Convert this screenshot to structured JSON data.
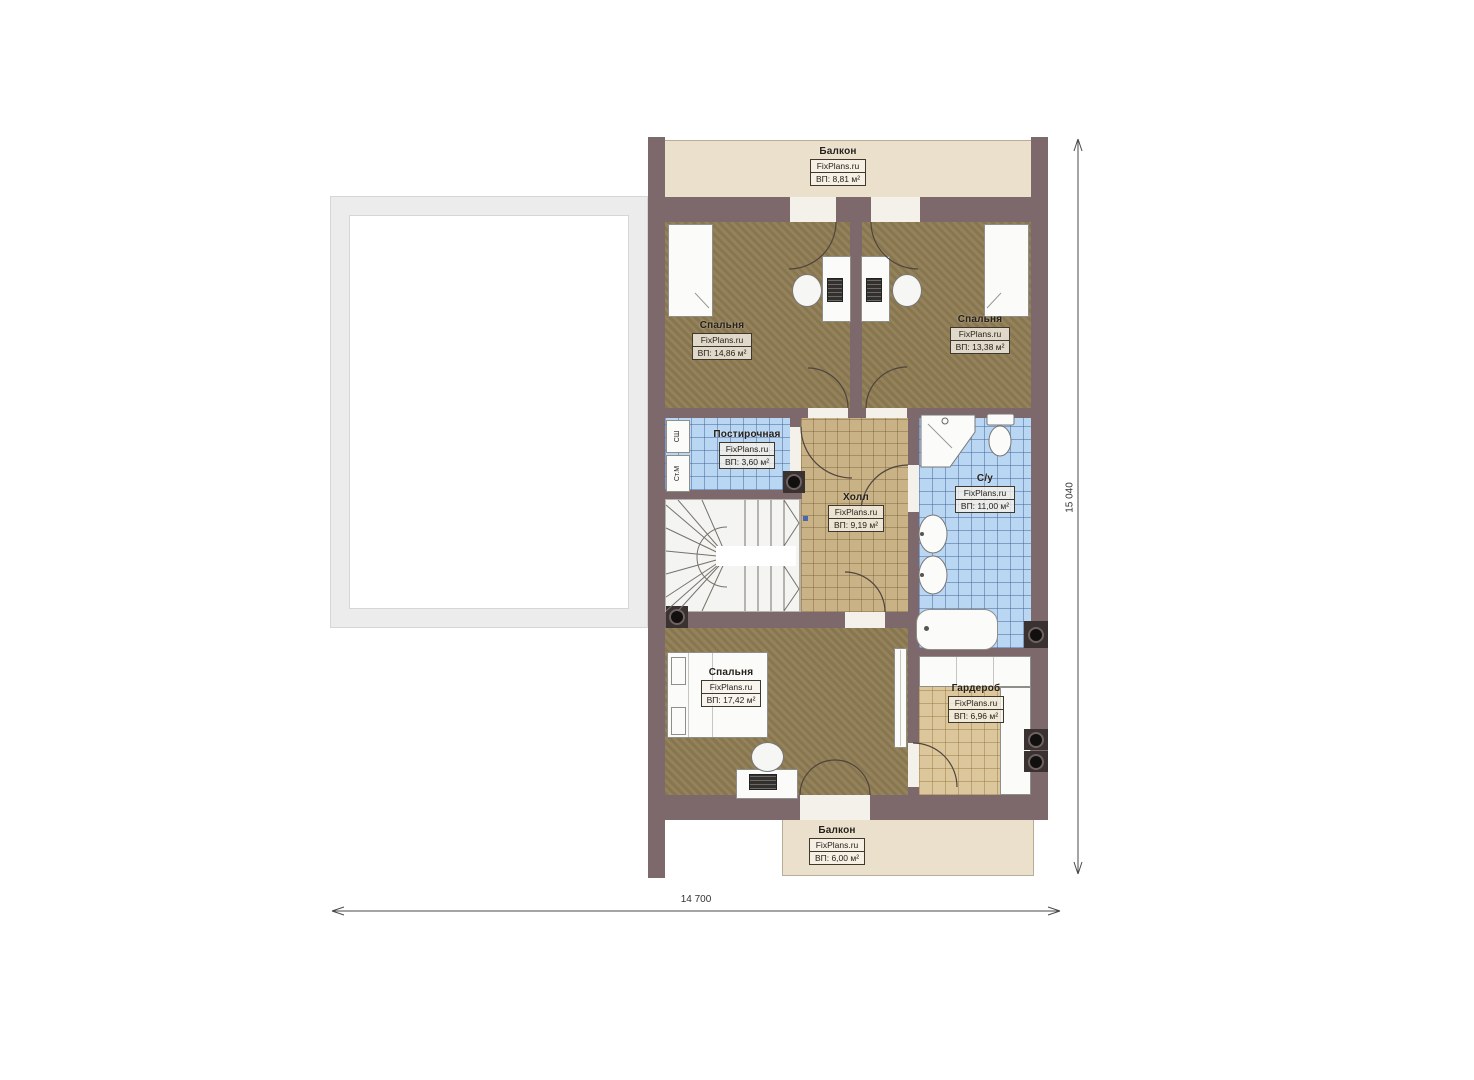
{
  "brand": "FixPlans.ru",
  "rooms": [
    {
      "name": "Балкон",
      "brand": "FixPlans.ru",
      "area": "ВП: 8,81 м²"
    },
    {
      "name": "Спальня",
      "brand": "FixPlans.ru",
      "area": "ВП: 14,86 м²"
    },
    {
      "name": "Спальня",
      "brand": "FixPlans.ru",
      "area": "ВП: 13,38 м²"
    },
    {
      "name": "Постирочная",
      "brand": "FixPlans.ru",
      "area": "ВП: 3,60 м²"
    },
    {
      "name": "Холл",
      "brand": "FixPlans.ru",
      "area": "ВП: 9,19 м²"
    },
    {
      "name": "С/у",
      "brand": "FixPlans.ru",
      "area": "ВП: 11,00 м²"
    },
    {
      "name": "Спальня",
      "brand": "FixPlans.ru",
      "area": "ВП: 17,42 м²"
    },
    {
      "name": "Гардероб",
      "brand": "FixPlans.ru",
      "area": "ВП: 6,96 м²"
    },
    {
      "name": "Балкон",
      "brand": "FixPlans.ru",
      "area": "ВП: 6,00 м²"
    }
  ],
  "appliances": {
    "dryer_cabinet": "СШ",
    "washing_machine": "Ст.М"
  },
  "dimensions": {
    "width": "14 700",
    "height": "15 040"
  },
  "colors": {
    "wall": "#7d696b",
    "bedroom_floor": "#8e7b53",
    "hall_floor": "#c8b286",
    "wet_room_tile": "#b9d6f2",
    "wardrobe_tile": "#dcc79c",
    "balcony": "#eae0cc",
    "stairs": "#f4f4f2"
  }
}
